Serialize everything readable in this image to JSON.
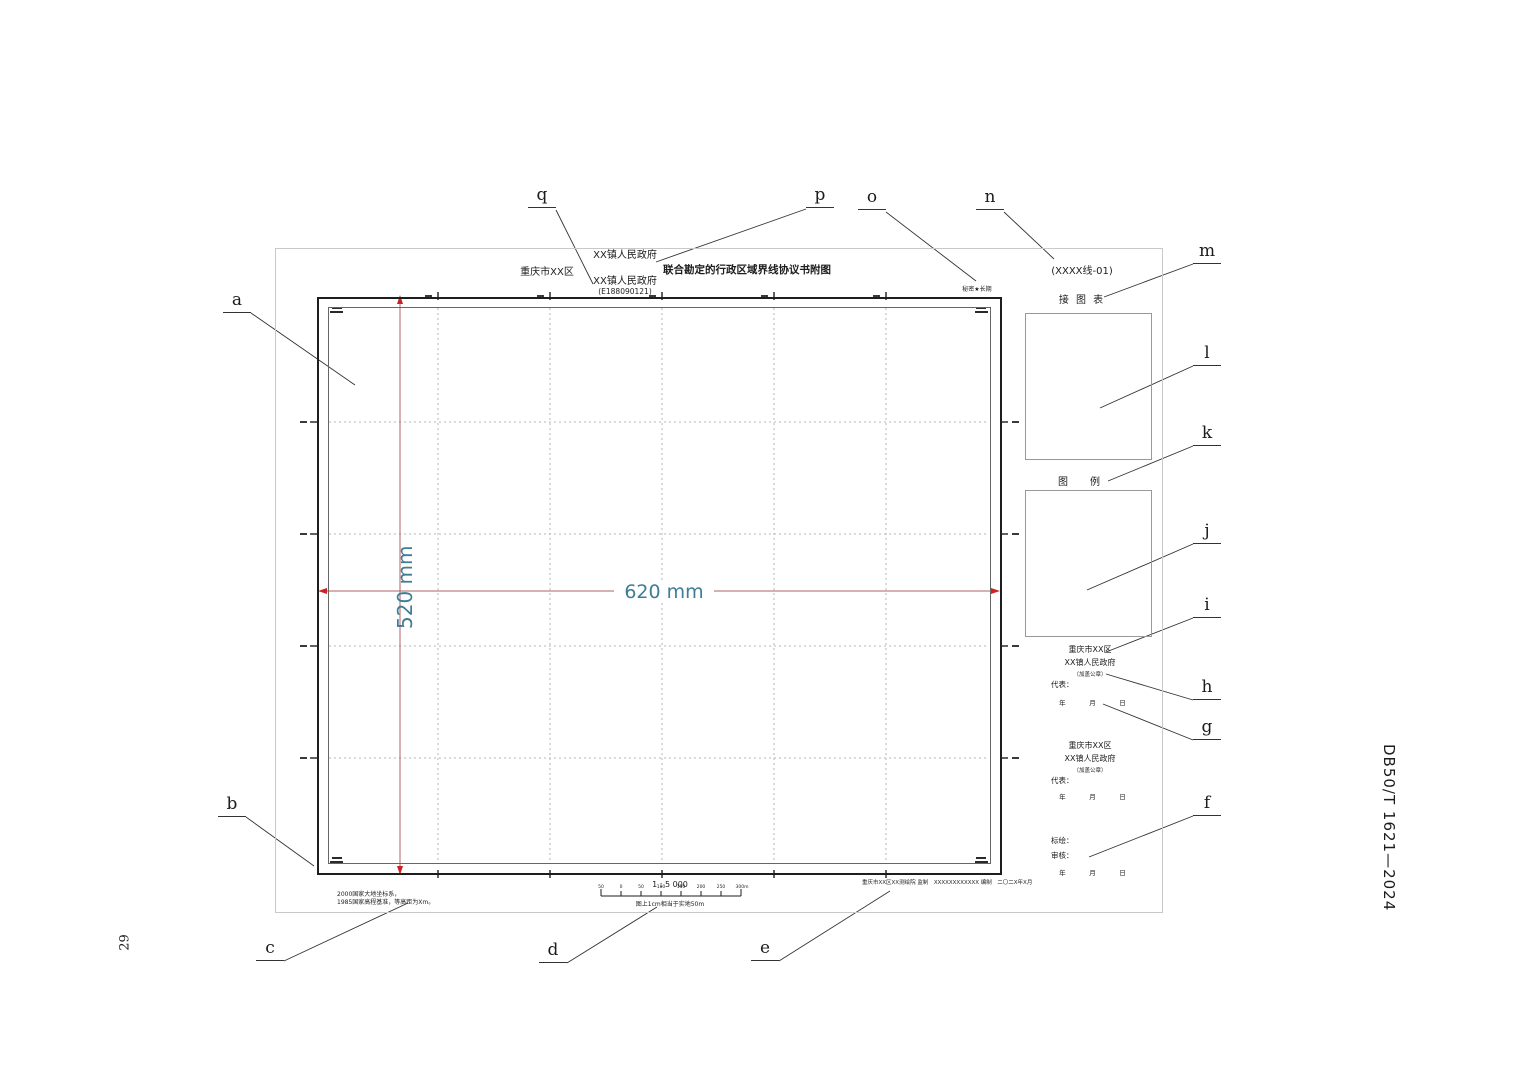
{
  "page": {
    "number": "29",
    "standard_code": "DB50/T 1621—2024"
  },
  "header": {
    "region": "重庆市XX区",
    "gov_top": "XX镇人民政府",
    "gov_bottom": "XX镇人民政府",
    "sheet_code": "(E188090121)",
    "title": "联合勘定的行政区域界线协议书附图",
    "security_mark": "秘密★长期"
  },
  "map": {
    "width_label": "620 mm",
    "height_label": "520 mm"
  },
  "right_panel": {
    "line_code": "(XXXX线-01)",
    "index_map_label": "接 图 表",
    "legend_label": "图　例",
    "signature_blocks": [
      {
        "region": "重庆市XX区",
        "gov": "XX镇人民政府",
        "seal_note": "（加盖公章）",
        "rep_label": "代表：",
        "date": "年　 月　 日"
      },
      {
        "region": "重庆市XX区",
        "gov": "XX镇人民政府",
        "seal_note": "（加盖公章）",
        "rep_label": "代表：",
        "date": "年　 月　 日"
      }
    ],
    "drafting": {
      "plot_label": "标绘：",
      "check_label": "审核：",
      "date": "年　 月　 日"
    }
  },
  "footer": {
    "datum_line1": "2000国家大地坐标系，",
    "datum_line2": "1985国家高程基准，等高距为Xm。",
    "scale_text": "1 : 5 000",
    "scale_bar_labels": [
      "50",
      "0",
      "50",
      "100",
      "150",
      "200",
      "250",
      "300m"
    ],
    "scale_caption": "图上1cm相当于实地50m",
    "credit_line": "重庆市XX区XX测绘院 监制　XXXXXXXXXXXX 编制　二〇二X年X月"
  },
  "callouts": {
    "a": "a",
    "b": "b",
    "c": "c",
    "d": "d",
    "e": "e",
    "f": "f",
    "g": "g",
    "h": "h",
    "i": "i",
    "j": "j",
    "k": "k",
    "l": "l",
    "m": "m",
    "n": "n",
    "o": "o",
    "p": "p",
    "q": "q"
  },
  "colors": {
    "dimension_text": "#3d7d96",
    "dimension_line": "#b06060",
    "arrow_red": "#cc2222",
    "grid": "#b5b5b5",
    "frame": "#1e1e1e",
    "paper_border": "#c9c9c9"
  }
}
